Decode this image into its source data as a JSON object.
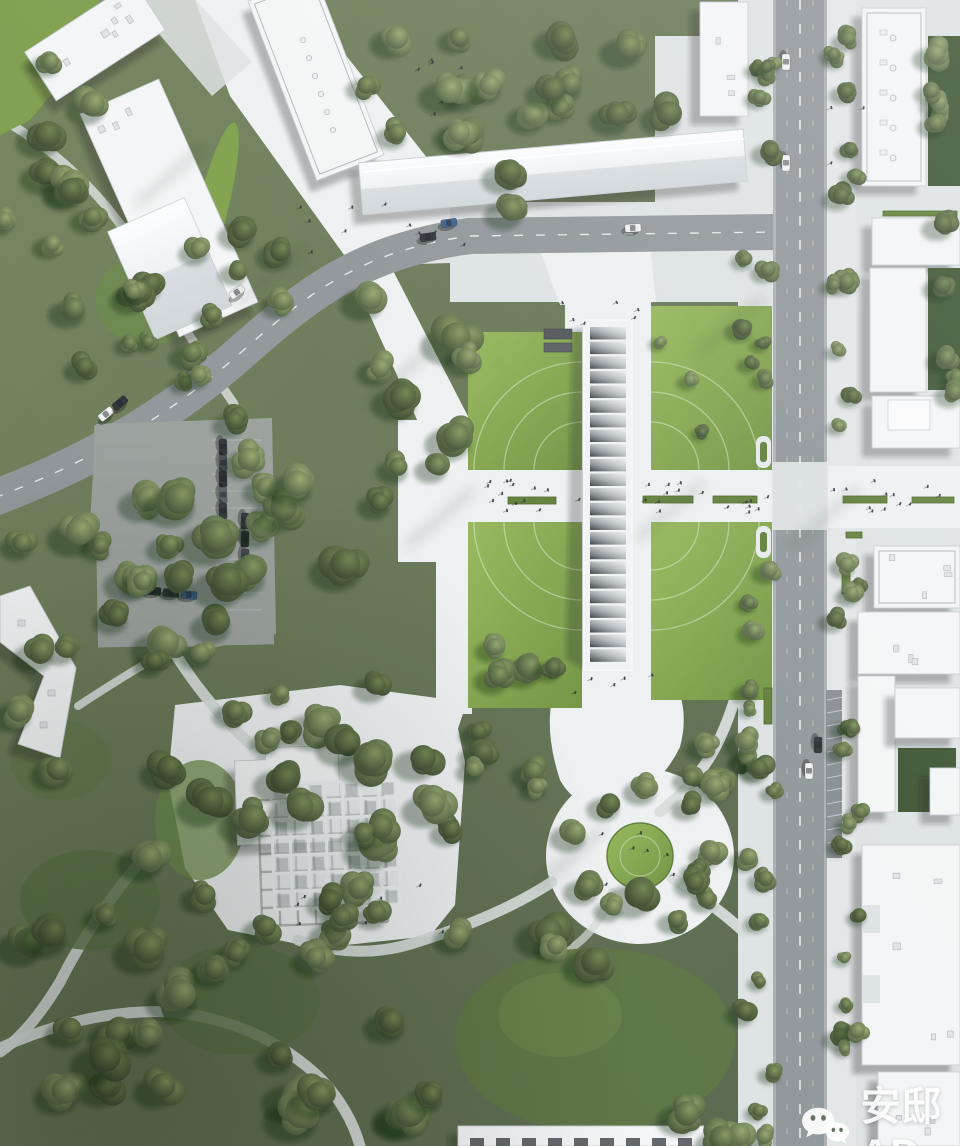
{
  "scene": {
    "kind": "aerial-architectural-rendering",
    "subject": "park masterplan bird's-eye view",
    "colonnade_bays": 23,
    "grid_canopy_cells": 7
  },
  "watermark": {
    "text": "安邸AD",
    "icon": "wechat-icon"
  },
  "palette": {
    "park_base_light": "#74845d",
    "park_base_dark": "#53634a",
    "lawn": "#85a84a",
    "lawn_highlight": "#96b75a",
    "lawn_deep": "#6f9340",
    "clearing_green": "#5d7442",
    "courtyard_green": "#3b5230",
    "hedge_green": "#5f7e38",
    "tree_dark": "#35432c",
    "tree_mid": "#4c5c3c",
    "tree_light": "#8a9c66",
    "pavement": "#dde2e3",
    "pavement_bright": "#edf0f1",
    "path": "#d6dcda",
    "asphalt": "#8f969a",
    "parking_lot": "#99a09c",
    "building_white": "#f3f5f6",
    "building_shade": "#dfe3e6",
    "building_stroke": "#c7cdd2",
    "car_dark": "#2e3338",
    "car_white": "#eff1f2",
    "car_blue": "#3c5e8a",
    "people_dot": "#2c3034",
    "watermark_white": "#ffffff"
  }
}
